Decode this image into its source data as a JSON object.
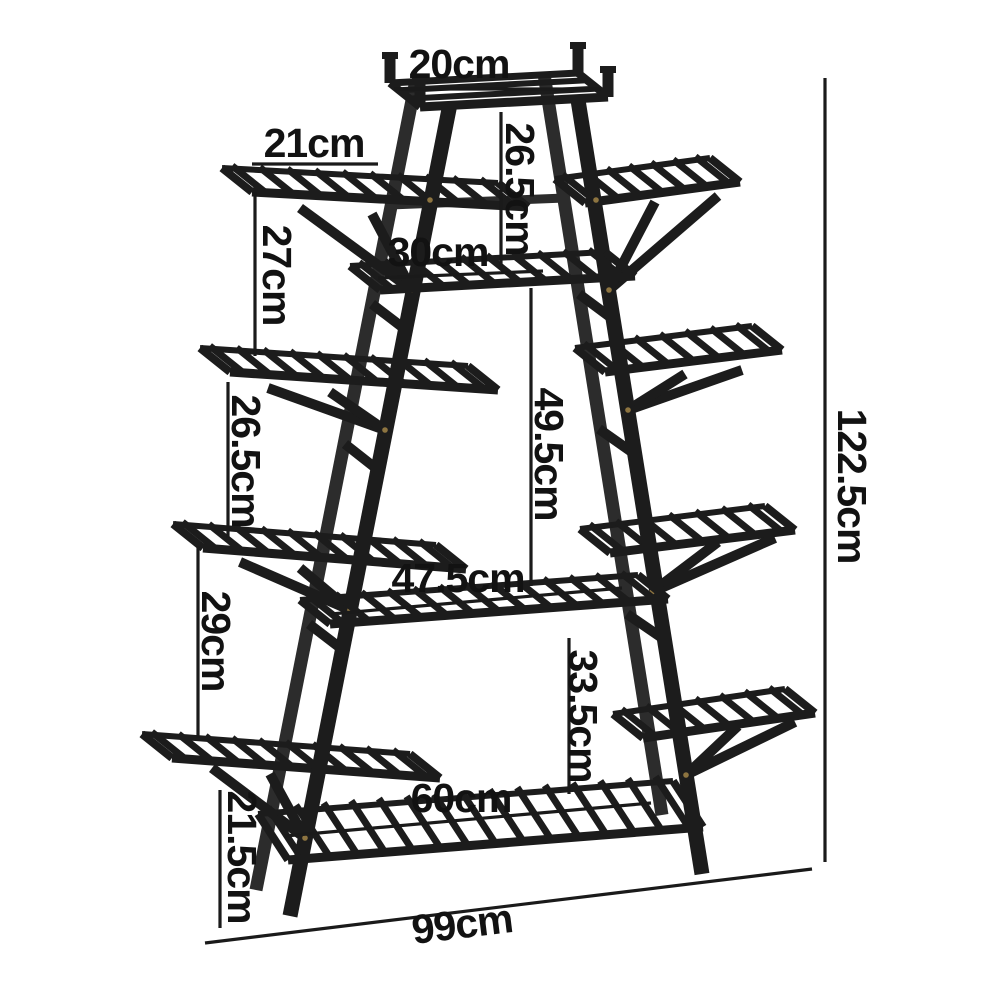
{
  "figure": {
    "type": "product-dimension-diagram",
    "subject": "a-frame tiered plant stand",
    "unit": "cm"
  },
  "colors": {
    "stand": "#1c1c1c",
    "stand_back": "#2c2c2c",
    "screw": "#8d7440",
    "dimension_line": "#1a1a1a",
    "label_text": "#121212",
    "background": "#ffffff"
  },
  "dimensions": [
    {
      "id": "top-shelf-width",
      "label": "20cm"
    },
    {
      "id": "upper-left-shelf-width",
      "label": "21cm"
    },
    {
      "id": "top-to-second-shelf-height",
      "label": "26.5cm"
    },
    {
      "id": "left-tier2-to-tier3-height",
      "label": "27cm"
    },
    {
      "id": "second-shelf-width",
      "label": "30cm"
    },
    {
      "id": "left-tier3-to-tier4-height",
      "label": "26.5cm"
    },
    {
      "id": "second-to-middle-shelf-height",
      "label": "49.5cm"
    },
    {
      "id": "middle-shelf-width",
      "label": "47.5cm"
    },
    {
      "id": "left-tier4-to-tier5-height",
      "label": "29cm"
    },
    {
      "id": "middle-to-bottom-shelf-height",
      "label": "33.5cm"
    },
    {
      "id": "bottom-shelf-width",
      "label": "60cm"
    },
    {
      "id": "left-tier5-to-floor-height",
      "label": "21.5cm"
    },
    {
      "id": "overall-width",
      "label": "99cm"
    },
    {
      "id": "overall-height",
      "label": "122.5cm"
    }
  ]
}
